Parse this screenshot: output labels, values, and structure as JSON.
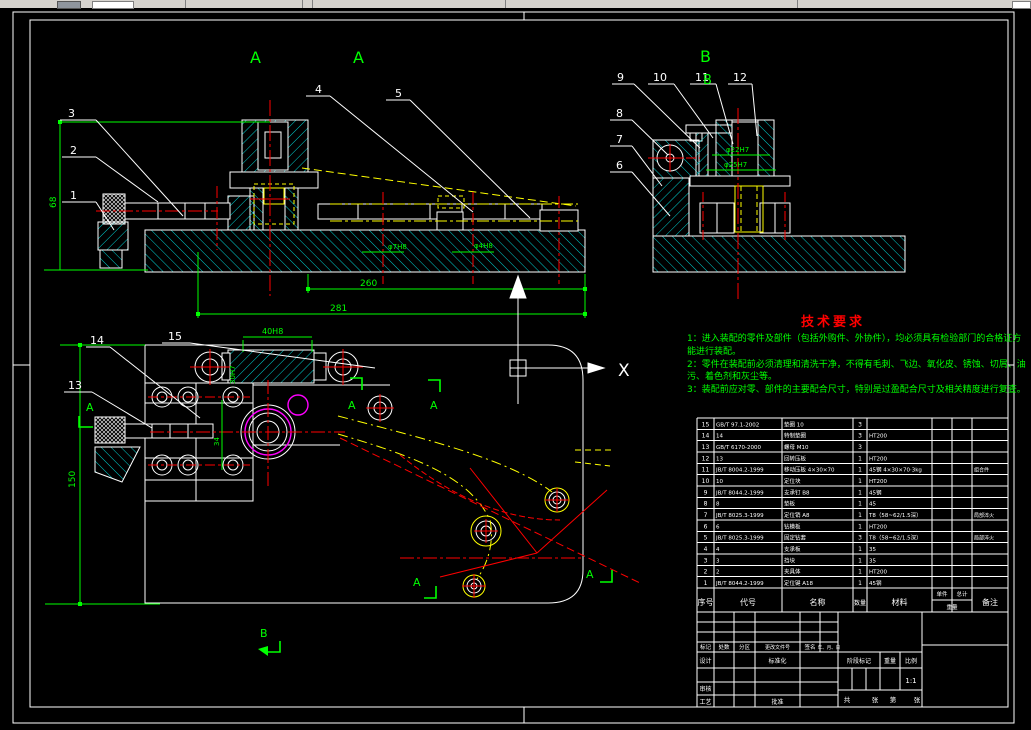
{
  "colors": {
    "background": "#000000",
    "line": "#ffffff",
    "hatch": "#00f0f0",
    "dimension": "#00ff00",
    "centerline": "#ff0000",
    "phantom": "#ffff00",
    "highlight": "#ff00ff",
    "tech_title": "#ff0000",
    "toolbar_bg": "#d6d3ce"
  },
  "views": {
    "front": {
      "section_marks": [
        "A",
        "A"
      ],
      "balloons": [
        "3",
        "2",
        "1",
        "4",
        "5"
      ],
      "dims": {
        "height": "68",
        "length_inner": "260",
        "length_total": "281",
        "hole_left": "φ7H8",
        "hole_right": "φ4H8"
      }
    },
    "side": {
      "view_labels": [
        "B",
        "B"
      ],
      "balloons": [
        "9",
        "10",
        "11",
        "12",
        "8",
        "7",
        "6"
      ],
      "dims": {
        "bore_top": "φ22H7",
        "bore_bottom": "φ25H7"
      }
    },
    "plan": {
      "balloons": [
        "14",
        "13",
        "15"
      ],
      "section_marks": [
        "A",
        "A",
        "A",
        "A",
        "A"
      ],
      "direction_mark": "B",
      "axis_mark": "X",
      "dims": {
        "width": "150",
        "slot": "40H8",
        "rail": "30H7",
        "offset": "34"
      }
    }
  },
  "tech_req": {
    "title": "技术要求",
    "lines": [
      "1：进入装配的零件及部件（包括外购件、外协件），均必须具有检验部门的合格证方",
      "能进行装配。",
      "2：零件在装配前必须清理和清洗干净，不得有毛刺、飞边、氧化皮、锈蚀、切屑、油",
      "污、着色剂和灰尘等。",
      "3：装配前应对零、部件的主要配合尺寸，特别是过盈配合尺寸及相关精度进行复查。"
    ]
  },
  "bom": {
    "header": {
      "no": "序号",
      "code": "代号",
      "name": "名称",
      "qty": "数量",
      "material": "材料",
      "unit": "单件",
      "total": "总计",
      "weight": "重量",
      "remark": "备注"
    },
    "rows": [
      {
        "no": "15",
        "code": "GB/T 97.1-2002",
        "name": "垫圈 10",
        "qty": "3",
        "material": "",
        "remark": ""
      },
      {
        "no": "14",
        "code": "14",
        "name": "特制垫圈",
        "qty": "3",
        "material": "HT200",
        "remark": ""
      },
      {
        "no": "13",
        "code": "GB/T 6170-2000",
        "name": "螺母 M10",
        "qty": "3",
        "material": "",
        "remark": ""
      },
      {
        "no": "12",
        "code": "13",
        "name": "回转压板",
        "qty": "1",
        "material": "HT200",
        "remark": ""
      },
      {
        "no": "11",
        "code": "JB/T 8004.2-1999",
        "name": "移动压板 4×30×70",
        "qty": "1",
        "material": "45钢 4×30×70·3kg",
        "remark": "组合件"
      },
      {
        "no": "10",
        "code": "10",
        "name": "定位块",
        "qty": "1",
        "material": "HT200",
        "remark": ""
      },
      {
        "no": "9",
        "code": "JB/T 8044.2-1999",
        "name": "支承钉 B8",
        "qty": "1",
        "material": "45钢",
        "remark": ""
      },
      {
        "no": "8",
        "code": "8",
        "name": "垫板",
        "qty": "1",
        "material": "45",
        "remark": ""
      },
      {
        "no": "7",
        "code": "JB/T 8025.3-1999",
        "name": "定位销 A8",
        "qty": "1",
        "material": "T8（58~62/1.5深）",
        "remark": "局部淬火"
      },
      {
        "no": "6",
        "code": "6",
        "name": "钻模板",
        "qty": "1",
        "material": "HT200",
        "remark": ""
      },
      {
        "no": "5",
        "code": "JB/T 8025.3-1999",
        "name": "固定钻套",
        "qty": "3",
        "material": "T8（58~62/1.5深）",
        "remark": "局部淬火"
      },
      {
        "no": "4",
        "code": "4",
        "name": "支承板",
        "qty": "1",
        "material": "35",
        "remark": ""
      },
      {
        "no": "3",
        "code": "3",
        "name": "挡块",
        "qty": "1",
        "material": "35",
        "remark": ""
      },
      {
        "no": "2",
        "code": "2",
        "name": "夹具体",
        "qty": "1",
        "material": "HT200",
        "remark": ""
      },
      {
        "no": "1",
        "code": "JB/T 8044.2-1999",
        "name": "定位键 A18",
        "qty": "1",
        "material": "45钢",
        "remark": ""
      }
    ]
  },
  "title_block": {
    "labels": {
      "mark": "标记",
      "count": "处数",
      "zone": "分区",
      "change_file": "更改文件号",
      "sign": "签名",
      "date": "年、月、日",
      "design": "设计",
      "standardization": "标准化",
      "review": "审核",
      "process": "工艺",
      "approve": "批准",
      "stage_mark": "阶段标记",
      "weight": "重量",
      "scale": "比例",
      "scale_value": "1:1",
      "sheet_total": "共",
      "sheet_zhang1": "张",
      "sheet_page": "第",
      "sheet_zhang2": "张"
    }
  }
}
